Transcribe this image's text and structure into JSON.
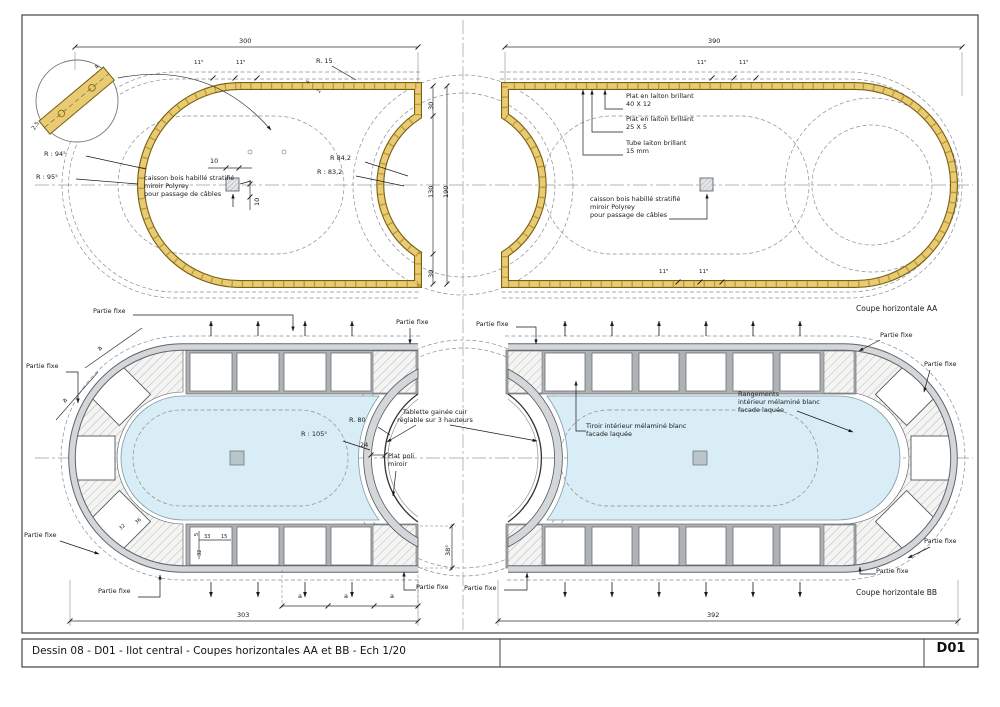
{
  "title_block": {
    "title": "Dessin 08 - D01 - Ilot central - Coupes horizontales AA et BB - Ech 1/20",
    "code": "D01"
  },
  "captions": {
    "coupe_aa": "Coupe horizontale AA",
    "coupe_bb": "Coupe horizontale BB"
  },
  "labels": {
    "partie_fixe": "Partie fixe",
    "caisson": "caisson bois habillé stratifié\nmiroir Polyrey\npour passage de câbles",
    "plat1": "Plat en laiton brillant\n40 X 12",
    "plat2": "Plat en laiton brillant\n25 X 5",
    "tube": "Tube laiton brillant\n15 mm",
    "tablette": "Tablette gainée cuir\nréglable sur 3 hauteurs",
    "plat_poli": "Plat poli\nmiroir",
    "rangements": "Rangements\nintérieur mélaminé blanc\nfacade laquée",
    "tiroir": "Tiroir intérieur mélaminé blanc\nfacade laquée"
  },
  "dims": {
    "d300": "300",
    "d390": "390",
    "d303": "303",
    "d392": "392",
    "d30": "30",
    "d130": "130",
    "d190": "190",
    "d10": "10",
    "d24": "24",
    "d38": "38⁵",
    "d_a": "a",
    "a11": "11⁵",
    "d4": "4",
    "d2": "2",
    "d25": "2,5",
    "r15": "R. 15",
    "r94": "R : 94⁵",
    "r95": "R : 95⁵",
    "r842": "R 84,2",
    "r832": "R : 83,2",
    "r80": "R. 80",
    "r105": "R : 105⁵",
    "t5": "5",
    "t33": "33",
    "t15": "15",
    "t32": "32",
    "t36": "36"
  },
  "colors": {
    "brass": "#e8cb72",
    "brass_edge": "#7a5f12",
    "interior_blue": "#d9edf6",
    "cabinet_gray": "#d3d7d9",
    "hatch_line": "#b7bbbd",
    "dash_line": "#8b8f92"
  }
}
